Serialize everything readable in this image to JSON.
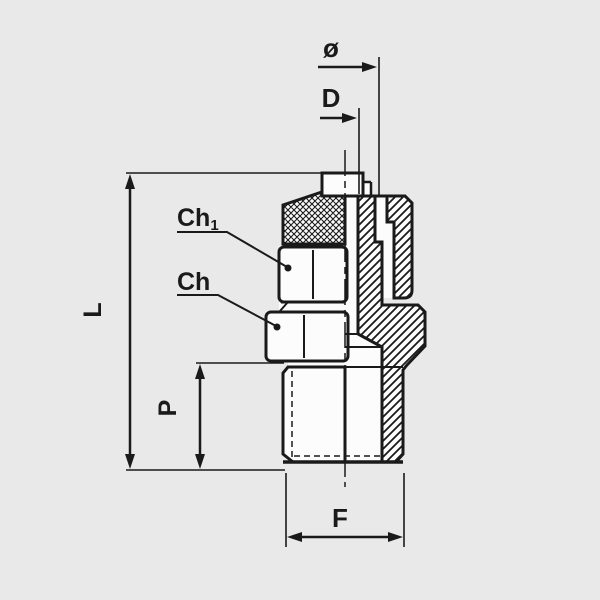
{
  "drawing": {
    "type": "technical-drawing",
    "subject": "male compression fitting, half-section view",
    "colors": {
      "background": "#e9e9e9",
      "line": "#1a1a1a",
      "part_fill": "#fcfcfc"
    },
    "labels": {
      "diameter": "ø",
      "d": "D",
      "ch1_base": "Ch",
      "ch1_sub": "1",
      "ch": "Ch",
      "l": "L",
      "p": "P",
      "f": "F"
    }
  }
}
